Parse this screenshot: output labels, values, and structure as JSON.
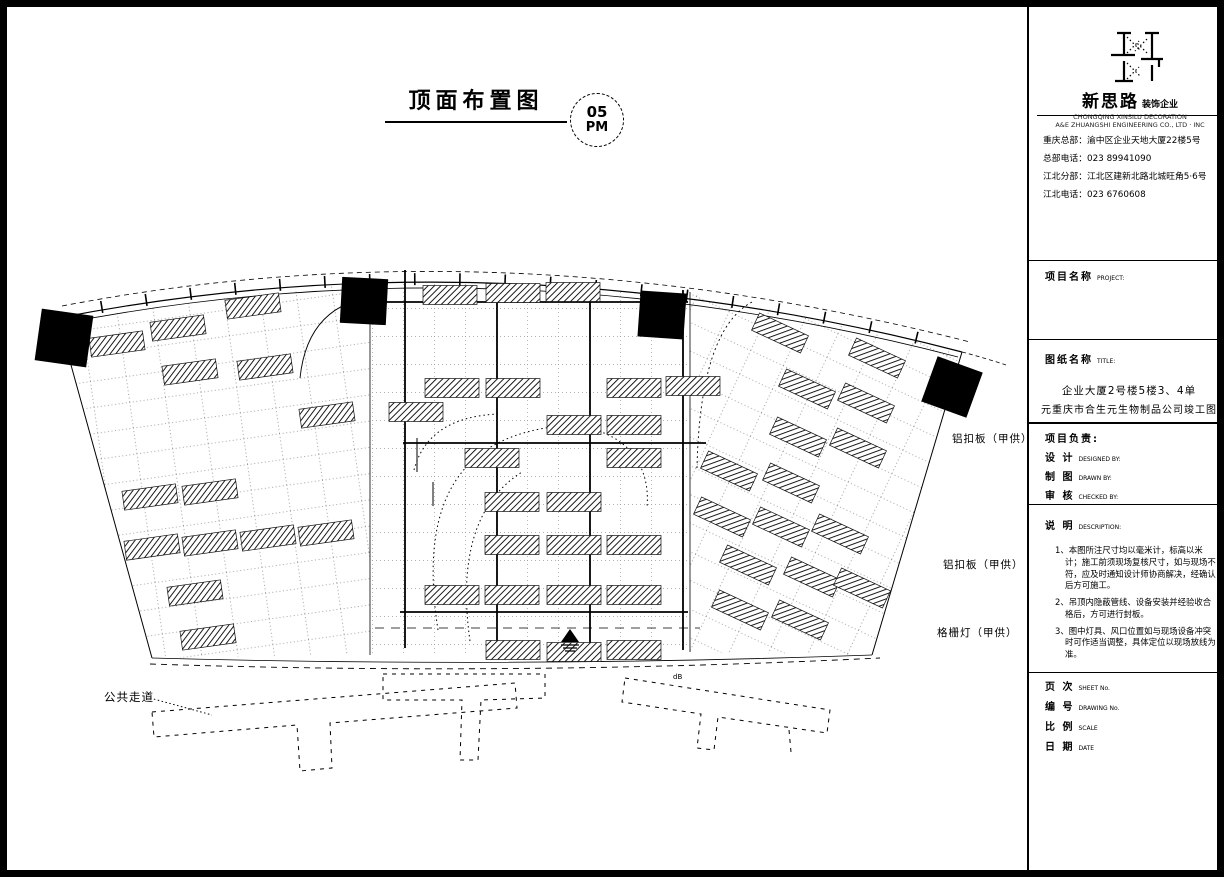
{
  "drawing": {
    "title": "顶面布置图",
    "detail_bubble": {
      "number": "05",
      "label": "PM"
    },
    "labels": {
      "ceiling_panel_1": "铝扣板（甲供）",
      "ceiling_panel_2": "铝扣板（甲供）",
      "grille_light": "格栅灯（甲供）",
      "public_corridor": "公共走道",
      "marker_b": "dB"
    }
  },
  "title_block": {
    "company": {
      "name": "新思路",
      "name_suffix": "装饰企业",
      "english_line1": "CHONGQING XINSILU DECORATION",
      "english_line2": "A&E ZHUANGSHI ENGINEERING CO., LTD · INC",
      "address_line1": "重庆总部：渝中区企业天地大厦22楼5号",
      "address_line2": "总部电话：023 89941090",
      "address_line3": "江北分部：江北区建新北路北城旺角5·6号",
      "address_line4": "江北电话：023 6760608"
    },
    "project_field": {
      "cn": "项目名称",
      "en": "PROJECT:"
    },
    "title_field": {
      "cn": "图纸名称",
      "en": "TITLE:"
    },
    "drawing_title": {
      "line1": "企业大厦2号楼5楼3、4单",
      "line2": "元重庆市合生元生物制品公司竣工图"
    },
    "staff": [
      {
        "cn": "项目负责:",
        "en": ""
      },
      {
        "cn": "设 计",
        "en": "DESIGNED BY:"
      },
      {
        "cn": "制 图",
        "en": "DRAWN BY:"
      },
      {
        "cn": "审 核",
        "en": "CHECKED BY:"
      }
    ],
    "notes_field": {
      "cn": "说 明",
      "en": "DESCRIPTION:"
    },
    "notes": [
      "1、本图所注尺寸均以毫米计，标高以米计；施工前须现场复核尺寸，如与现场不符，应及时通知设计师协商解决，经确认后方可施工。",
      "2、吊顶内隐蔽管线、设备安装并经验收合格后，方可进行封板。",
      "3、图中灯具、风口位置如与现场设备冲突时可作适当调整，具体定位以现场放线为准。"
    ],
    "footer": [
      {
        "cn": "页 次",
        "en": "SHEET No."
      },
      {
        "cn": "编 号",
        "en": "DRAWING No."
      },
      {
        "cn": "比 例",
        "en": "SCALE"
      },
      {
        "cn": "日 期",
        "en": "DATE"
      }
    ]
  }
}
